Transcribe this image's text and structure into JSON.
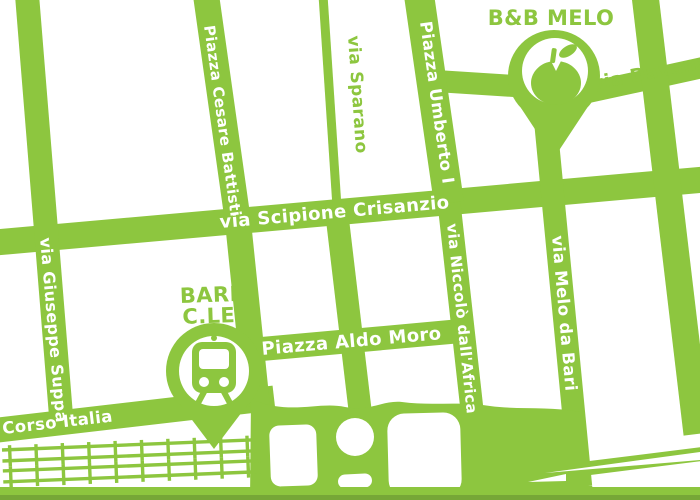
{
  "colors": {
    "green": "#8dc63f",
    "green-dark": "#76a737",
    "white": "#ffffff"
  },
  "map": {
    "street_labels": {
      "cesare_battisti": "Piazza Cesare Battisti",
      "sparano": "via Sparano",
      "umberto": "Piazza Umberto I",
      "davanzale": "via Davanzale",
      "crisanzio": "via Scipione Crisanzio",
      "suppa": "via Giuseppe Suppa",
      "niccolo": "via Niccolò dall'Africa",
      "melo": "via Melo da Bari",
      "aldo_moro": "Piazza Aldo Moro",
      "corso_italia": "Corso Italia"
    },
    "markers": {
      "bnb": {
        "label": "B&B MELO",
        "icon": "apple-icon"
      },
      "station": {
        "label_line1": "BARI",
        "label_line2": "C.LE",
        "icon": "train-icon"
      }
    }
  }
}
